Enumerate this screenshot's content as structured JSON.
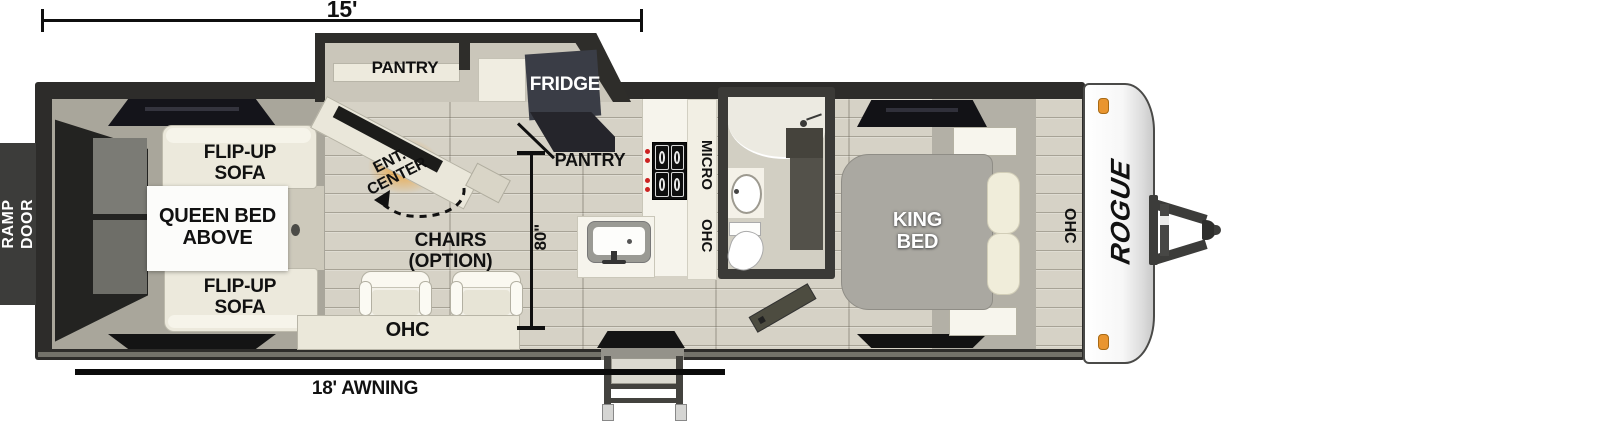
{
  "dimensions": {
    "length": "15'",
    "awning": "18' AWNING",
    "galley_width": "80\""
  },
  "exterior": {
    "ramp_door": "RAMP\nDOOR",
    "logo": "ROGUE"
  },
  "slide_out": {
    "pantry": "PANTRY",
    "fridge": "FRIDGE"
  },
  "garage": {
    "sofa_top": "FLIP-UP\nSOFA",
    "sofa_bottom": "FLIP-UP\nSOFA",
    "queen_bed": "QUEEN BED\nABOVE"
  },
  "living": {
    "ent_center": "ENT.\nCENTER",
    "chairs": "CHAIRS\n(OPTION)",
    "ohc": "OHC"
  },
  "kitchen": {
    "pantry": "PANTRY",
    "micro": "MICRO",
    "ohc": "OHC"
  },
  "bedroom": {
    "king_bed": "KING\nBED",
    "ohc": "OHC"
  },
  "colors": {
    "wall": "#2d2c2a",
    "floor": "#d6d2c6",
    "cabinet_cream": "#ece9dc",
    "fridge_dark": "#3a3d46",
    "marker_orange": "#e9952f",
    "flame_orange": "#f39c21"
  }
}
